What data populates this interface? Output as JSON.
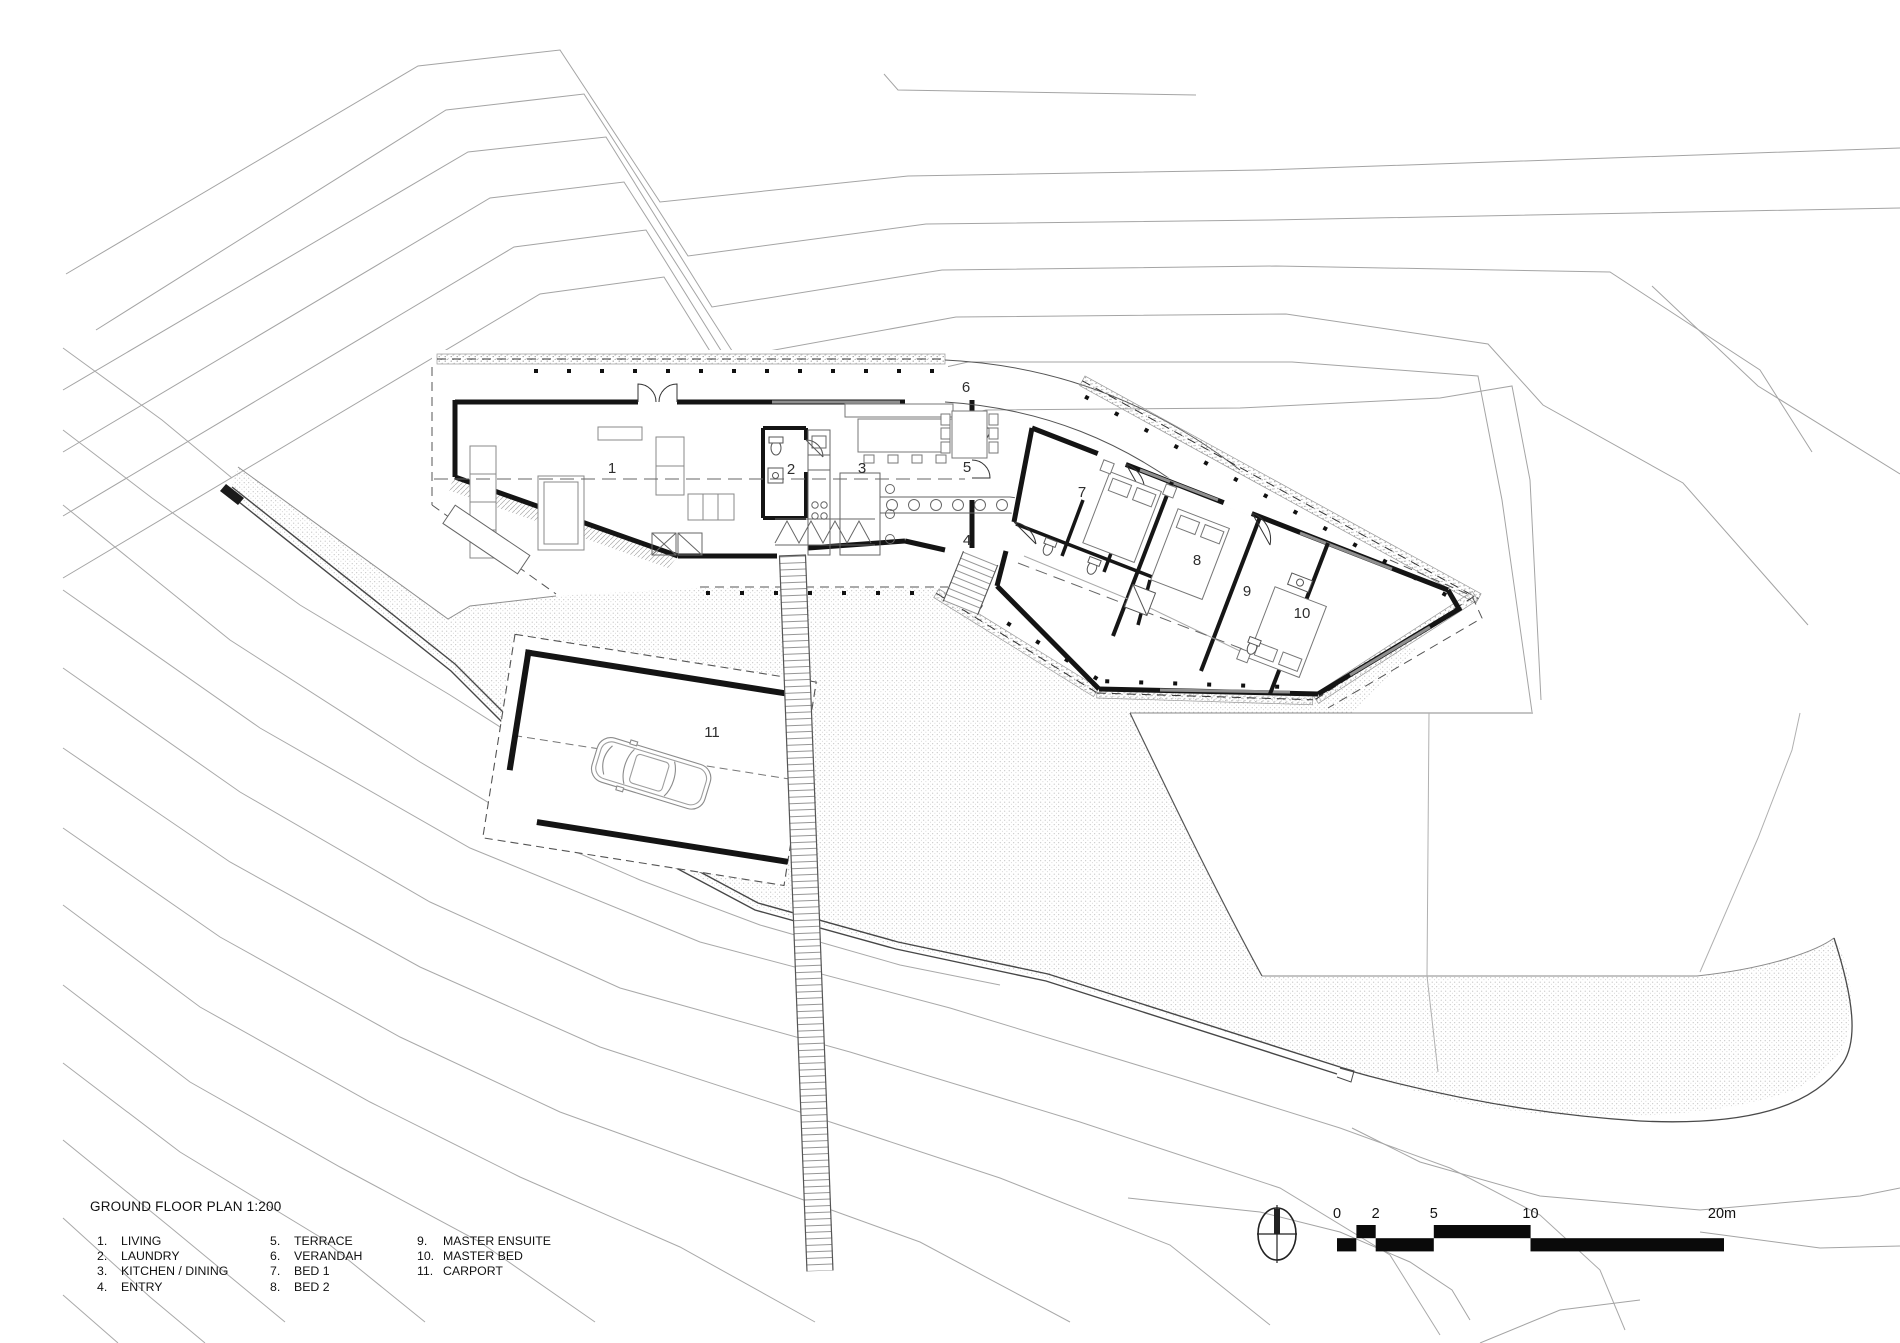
{
  "drawing": {
    "title": "GROUND FLOOR PLAN 1:200",
    "legend": {
      "items": [
        {
          "num": "1.",
          "label": "LIVING"
        },
        {
          "num": "2.",
          "label": "LAUNDRY"
        },
        {
          "num": "3.",
          "label": "KITCHEN / DINING"
        },
        {
          "num": "4.",
          "label": "ENTRY"
        },
        {
          "num": "5.",
          "label": "TERRACE"
        },
        {
          "num": "6.",
          "label": "VERANDAH"
        },
        {
          "num": "7.",
          "label": "BED 1"
        },
        {
          "num": "8.",
          "label": "BED 2"
        },
        {
          "num": "9.",
          "label": "MASTER ENSUITE"
        },
        {
          "num": "10.",
          "label": "MASTER BED"
        },
        {
          "num": "11.",
          "label": "CARPORT"
        }
      ]
    },
    "plan_labels": [
      {
        "num": "1"
      },
      {
        "num": "2"
      },
      {
        "num": "3"
      },
      {
        "num": "4"
      },
      {
        "num": "5"
      },
      {
        "num": "6"
      },
      {
        "num": "7"
      },
      {
        "num": "8"
      },
      {
        "num": "9"
      },
      {
        "num": "10"
      },
      {
        "num": "11"
      }
    ],
    "scale_bar": {
      "labels": [
        "0",
        "2",
        "5",
        "10",
        "20m"
      ]
    },
    "icons": {
      "north_arrow": "north-arrow-icon"
    },
    "colors": {
      "paper": "#ffffff",
      "wall": "#141414",
      "contour": "#a4a4a4",
      "glazing": "#8f8f8f",
      "dash": "#555555",
      "stipple_dot": "#b4b4b4"
    }
  }
}
